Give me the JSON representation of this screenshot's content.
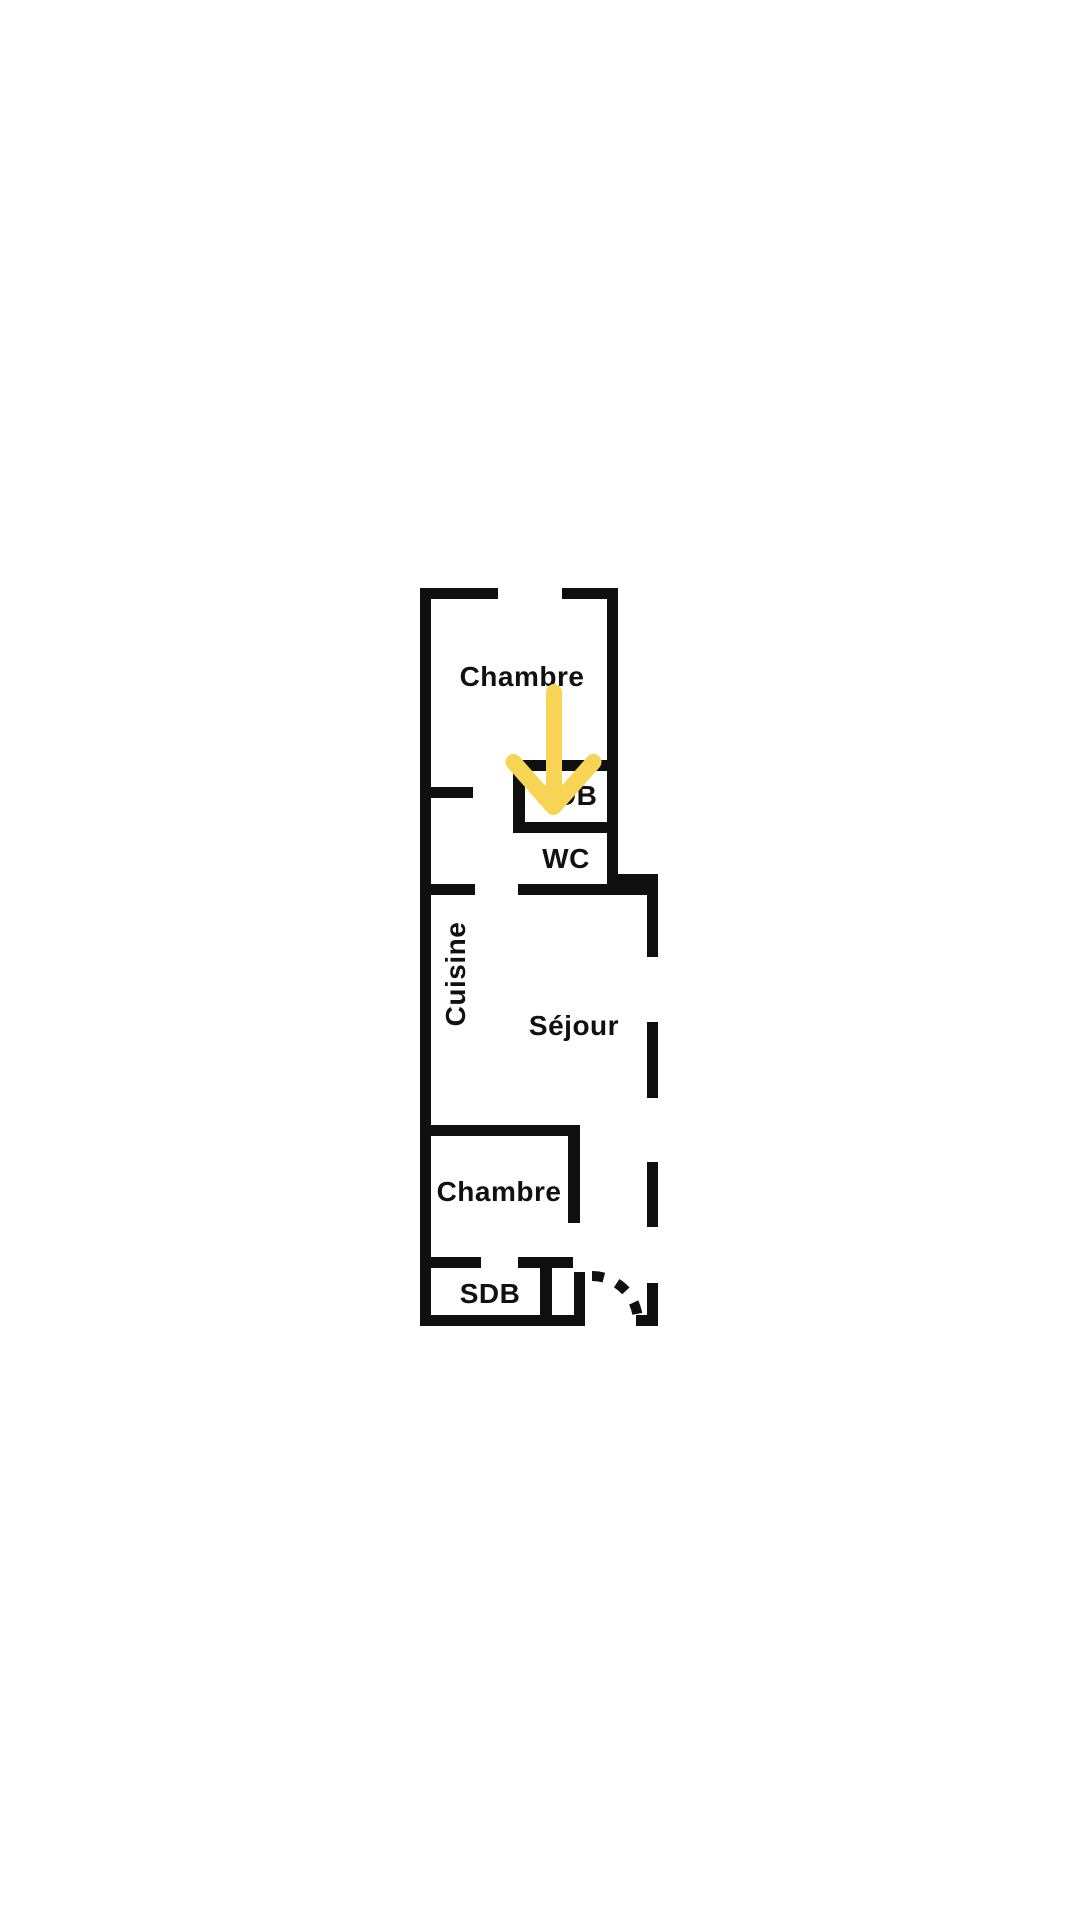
{
  "floor_plan": {
    "rooms": {
      "bedroom_top": {
        "label": "Chambre"
      },
      "bathroom_top": {
        "label": "SDB"
      },
      "wc": {
        "label": "WC"
      },
      "kitchen": {
        "label": "Cuisine"
      },
      "living_room": {
        "label": "Séjour"
      },
      "bedroom_bottom": {
        "label": "Chambre"
      },
      "bathroom_bottom": {
        "label": "SDB"
      }
    },
    "colors": {
      "wall": "#0f0f0f",
      "background": "#ffffff",
      "arrow": "#f8d455"
    }
  }
}
